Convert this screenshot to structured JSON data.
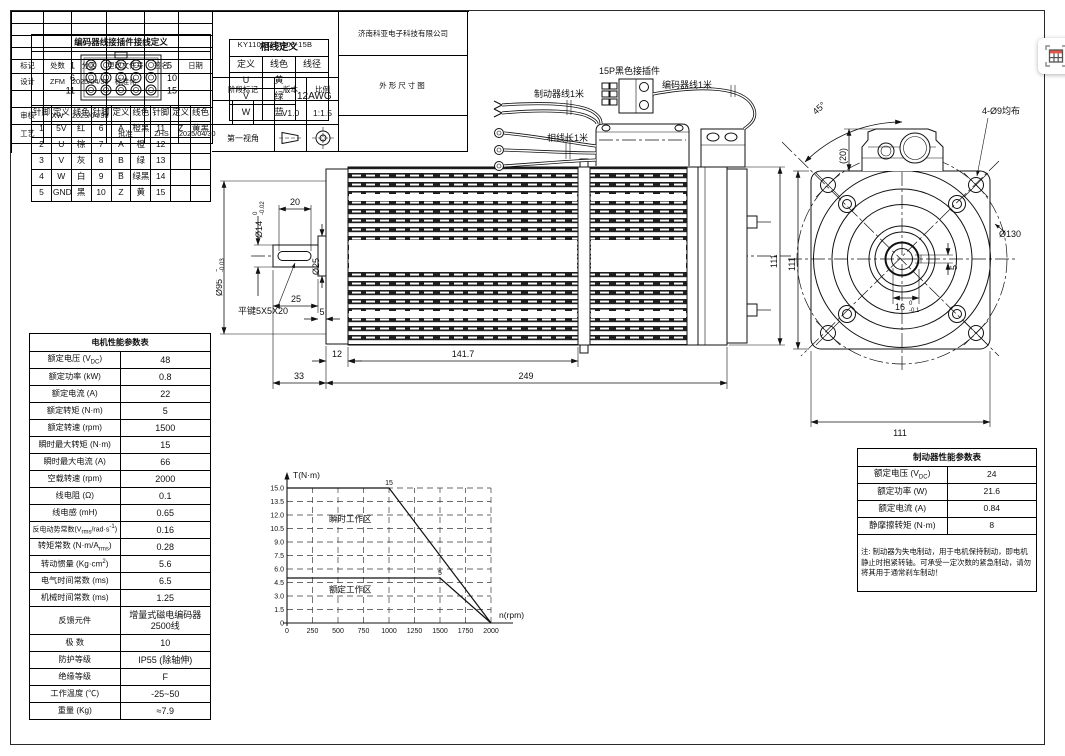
{
  "encoder_table": {
    "title": "编码器线接插件接线定义",
    "pin_rows": [
      [
        "1",
        "5"
      ],
      [
        "6",
        "10"
      ],
      [
        "11",
        "15"
      ]
    ],
    "headers": [
      "针脚",
      "定义",
      "线色"
    ],
    "rows": [
      [
        "1",
        "5V",
        "红",
        "6",
        "A̅",
        "橙黑",
        "11",
        "Z̅",
        "黄黑"
      ],
      [
        "2",
        "U",
        "棕",
        "7",
        "A",
        "橙",
        "12",
        "",
        ""
      ],
      [
        "3",
        "V",
        "灰",
        "8",
        "B",
        "绿",
        "13",
        "",
        ""
      ],
      [
        "4",
        "W",
        "白",
        "9",
        "B̅",
        "绿黑",
        "14",
        "",
        ""
      ],
      [
        "5",
        "GND",
        "黑",
        "10",
        "Z",
        "黄",
        "15",
        "",
        ""
      ]
    ]
  },
  "phase_table": {
    "title": "相线定义",
    "headers": [
      "定义",
      "线色",
      "线径"
    ],
    "rows": [
      [
        "U",
        "黄"
      ],
      [
        "V",
        "绿"
      ],
      [
        "W",
        "蓝"
      ]
    ],
    "gauge": "12AWG"
  },
  "motor_table": {
    "title": "电机性能参数表",
    "rows": [
      {
        "l": "额定电压 (V<sub>DC</sub>)",
        "v": "48"
      },
      {
        "l": "额定功率 (kW)",
        "v": "0.8"
      },
      {
        "l": "额定电流 (A)",
        "v": "22"
      },
      {
        "l": "额定转矩 (N·m)",
        "v": "5"
      },
      {
        "l": "额定转速 (rpm)",
        "v": "1500"
      },
      {
        "l": "瞬时最大转矩 (N·m)",
        "v": "15"
      },
      {
        "l": "瞬时最大电流 (A)",
        "v": "66"
      },
      {
        "l": "空载转速 (rpm)",
        "v": "2000"
      },
      {
        "l": "线电阻 (Ω)",
        "v": "0.1"
      },
      {
        "l": "线电感 (mH)",
        "v": "0.65"
      },
      {
        "l": "反电动势常数(V<sub>rms</sub>/rad·s<sup>-1</sup>)",
        "v": "0.16"
      },
      {
        "l": "转矩常数 (N·m/A<sub>rms</sub>)",
        "v": "0.28"
      },
      {
        "l": "转动惯量 (Kg·cm<sup>2</sup>)",
        "v": "5.6"
      },
      {
        "l": "电气时间常数 (ms)",
        "v": "6.5"
      },
      {
        "l": "机械时间常数 (ms)",
        "v": "1.25"
      },
      {
        "l": "反馈元件",
        "v": "增量式磁电编码器<br>2500线"
      },
      {
        "l": "极 数",
        "v": "10"
      },
      {
        "l": "防护等级",
        "v": "IP55 (除轴伸)"
      },
      {
        "l": "绝缘等级",
        "v": "F"
      },
      {
        "l": "工作温度 (℃)",
        "v": "-25~50"
      },
      {
        "l": "重量 (Kg)",
        "v": "≈7.9"
      }
    ]
  },
  "brake_table": {
    "title": "制动器性能参数表",
    "rows": [
      {
        "l": "额定电压 (V<sub>DC</sub>)",
        "v": "24"
      },
      {
        "l": "额定功率 (W)",
        "v": "21.6"
      },
      {
        "l": "额定电流 (A)",
        "v": "0.84"
      },
      {
        "l": "静摩擦转矩 (N·m)",
        "v": "8"
      }
    ],
    "note": "注: 制动器为失电制动，用于电机保持制动，即电机静止时抱紧转轴。可承受一定次数的紧急制动，请勿将其用于通常刹车制动！"
  },
  "chart_data": {
    "type": "line",
    "title": "",
    "xlabel": "n(rpm)",
    "ylabel": "T(N·m)",
    "xlim": [
      0,
      2000
    ],
    "ylim": [
      0,
      15
    ],
    "xticks": [
      0,
      250,
      500,
      750,
      1000,
      1250,
      1500,
      1750,
      2000
    ],
    "yticks": [
      0,
      1.5,
      3,
      4.5,
      6,
      7.5,
      9,
      10.5,
      12,
      13.5,
      15
    ],
    "grid": "dashed",
    "legend": "none",
    "series": [
      {
        "name": "瞬时转矩边界",
        "x": [
          0,
          1000,
          2000
        ],
        "y": [
          15,
          15,
          0
        ],
        "knee_x": 1000,
        "knee_y": 15,
        "knee_label": "15"
      },
      {
        "name": "额定转矩边界",
        "x": [
          0,
          1500,
          2000
        ],
        "y": [
          5,
          5,
          0
        ],
        "knee_x": 1500,
        "knee_y": 5,
        "knee_label": "5"
      }
    ],
    "annotations": [
      {
        "text": "瞬时工作区",
        "x": 620,
        "y": 11.2
      },
      {
        "text": "额定工作区",
        "x": 620,
        "y": 3.4
      }
    ]
  },
  "drawing": {
    "labels": {
      "brake_wire": "制动器线1米",
      "connector_15p": "15P黑色接插件",
      "encoder_wire": "编码器线1米",
      "phase_wire": "相线长1米",
      "key_label": "平键5X5X20"
    },
    "side": {
      "flange_dia": "Ø95",
      "flange_tol_top": "0",
      "flange_tol_bot": "-0.03",
      "shaft_dia": "Ø14",
      "shaft_tol_top": "0",
      "shaft_tol_bot": "-0.02",
      "key_len": "20",
      "collar_dia": "Ø25",
      "shaft_len": "25",
      "collar_len": "5",
      "flange_thk": "12",
      "fin_len": "141.7",
      "shaft_total": "33",
      "total_len": "249",
      "body_h": "111"
    },
    "front": {
      "angle": "45°",
      "box_h": "(20)",
      "holes": "4-Ø9均布",
      "flange_circle": "Ø130",
      "height": "111",
      "width": "111",
      "key_w": "16",
      "key_w_tol_top": "0",
      "key_w_tol_bot": "-0.1",
      "key_depth": "5"
    }
  },
  "title_block": {
    "part_number": "KY110ACS0408-15B",
    "company": "济南科亚电子科技有限公司",
    "drawing_title": "外形尺寸图",
    "stage_label": "阶段标记",
    "version_label": "版本",
    "scale_label": "比例",
    "version": "V1.0",
    "scale": "1:1.5",
    "projection_label": "第一视角",
    "rev_table": {
      "headers": [
        "标记",
        "处数",
        "分区",
        "更改文件号",
        "签名",
        "日期"
      ],
      "rows": [
        [
          "设计",
          "ZFM",
          "2025/04/30",
          "标准化",
          "",
          ""
        ],
        [
          "",
          "",
          "",
          "",
          "",
          ""
        ],
        [
          "审核",
          "XW",
          "2025/04/30",
          "",
          "",
          ""
        ],
        [
          "工艺",
          "",
          "",
          "批准",
          "ZHS",
          "2025/04/30"
        ]
      ]
    }
  }
}
